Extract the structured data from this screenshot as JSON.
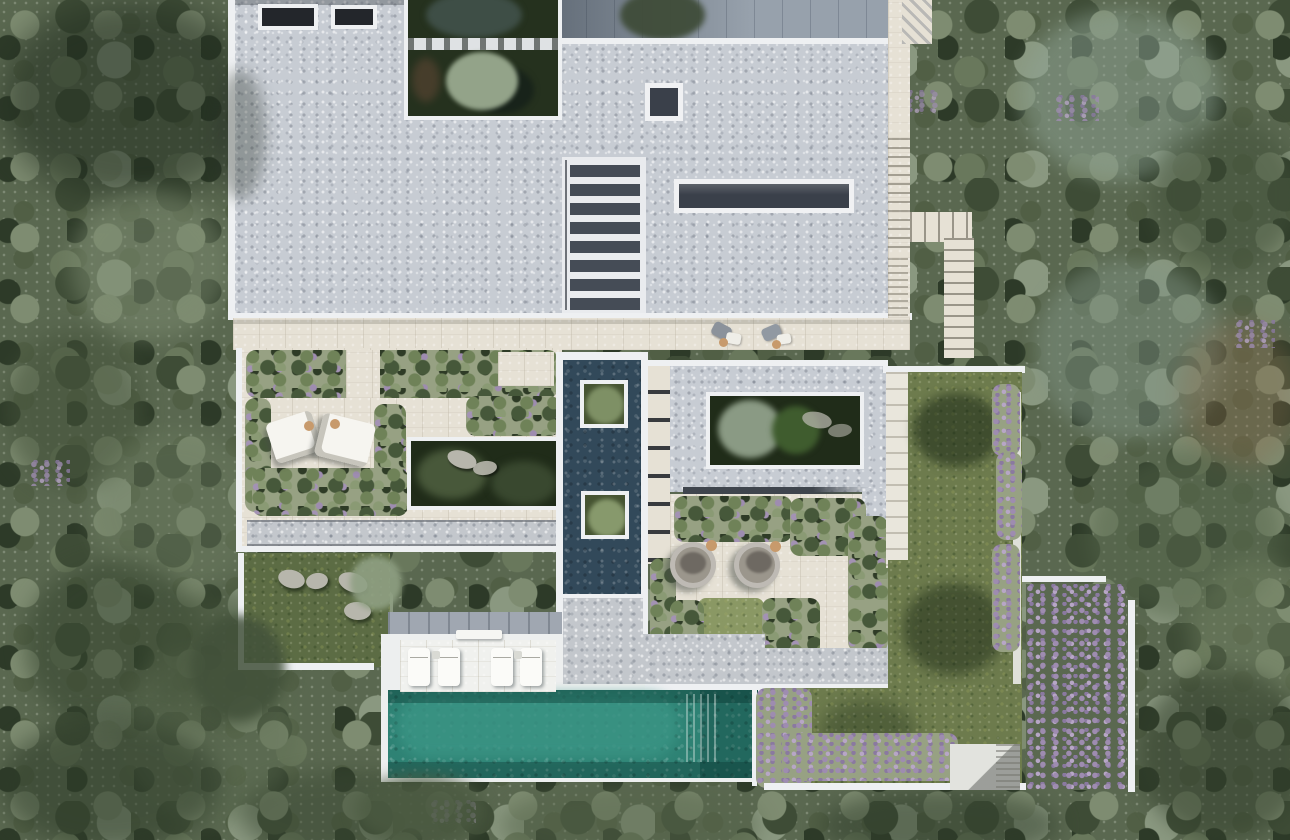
{
  "scene": {
    "kind": "aerial-architectural-render",
    "description": "Top-down render of a modern flat-roofed villa with gravel roof, skylights, sunken courtyards, reflecting pool, swimming pool, lawns and surrounding olive forest",
    "colors": {
      "forest_base": "#5a6850",
      "forest_dark": "#33402c",
      "forest_sage": "#8ea394",
      "roof_gravel": "#c7ccd3",
      "gravel_light": "#c3c7cc",
      "white_edge": "#eef0f2",
      "travertine": "#e6e1d5",
      "shadow_terrace": "#97a1ac",
      "skylight": "#3a404a",
      "vent_dark": "#23262b",
      "courtyard_green": "#25311e",
      "sunken_garden": "#202c19",
      "reflecting_pool": "#32495a",
      "pool_water": "#2e8274",
      "lawn": "#6d7b4d",
      "lawn_dark": "#5c6c44",
      "bed_ground": "#97a183",
      "boulder": "#b7b6ac",
      "canopy_white": "#f6f5f0",
      "wicker": "#9b968c",
      "table_tan": "#c79a6c",
      "flower_purple": "#9e8cb0"
    },
    "features": {
      "roof_vents": 2,
      "roof_stair_treads": 8,
      "roof_skylights": 2,
      "reflecting_pool_planters": 2,
      "canopy_daybeds": 2,
      "round_daybeds": 2,
      "pool_loungers": 4,
      "sunken_gardens": 2
    }
  }
}
